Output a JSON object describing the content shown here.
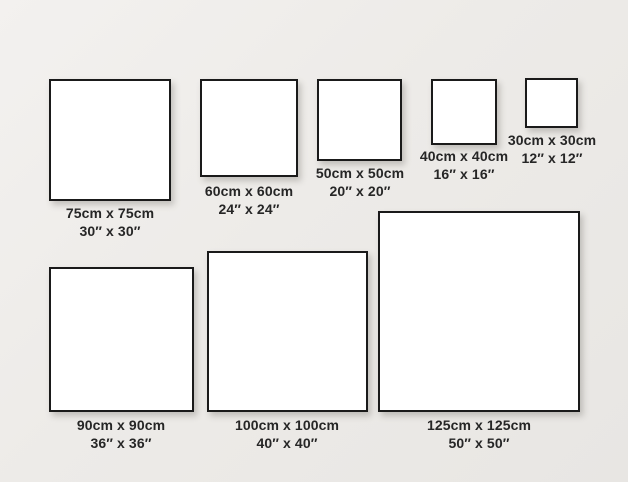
{
  "diagram": {
    "description": "Square canvas size comparison chart",
    "colors": {
      "background": "#edebe8",
      "frame_fill": "#ffffff",
      "frame_border": "#1a1a1a",
      "label_text": "#262626"
    }
  },
  "items": [
    {
      "id": "75",
      "cm": 75,
      "inches": 30,
      "cm_label": "75cm x 75cm",
      "inch_label": "30″ x 30″"
    },
    {
      "id": "60",
      "cm": 60,
      "inches": 24,
      "cm_label": "60cm x 60cm",
      "inch_label": "24″ x 24″"
    },
    {
      "id": "50",
      "cm": 50,
      "inches": 20,
      "cm_label": "50cm x 50cm",
      "inch_label": "20″ x 20″"
    },
    {
      "id": "40",
      "cm": 40,
      "inches": 16,
      "cm_label": "40cm x 40cm",
      "inch_label": "16″ x 16″"
    },
    {
      "id": "30",
      "cm": 30,
      "inches": 12,
      "cm_label": "30cm x 30cm",
      "inch_label": "12″ x 12″"
    },
    {
      "id": "90",
      "cm": 90,
      "inches": 36,
      "cm_label": "90cm x 90cm",
      "inch_label": "36″ x 36″"
    },
    {
      "id": "100",
      "cm": 100,
      "inches": 40,
      "cm_label": "100cm x 100cm",
      "inch_label": "40″ x 40″"
    },
    {
      "id": "125",
      "cm": 125,
      "inches": 50,
      "cm_label": "125cm x 125cm",
      "inch_label": "50″ x 50″"
    }
  ]
}
